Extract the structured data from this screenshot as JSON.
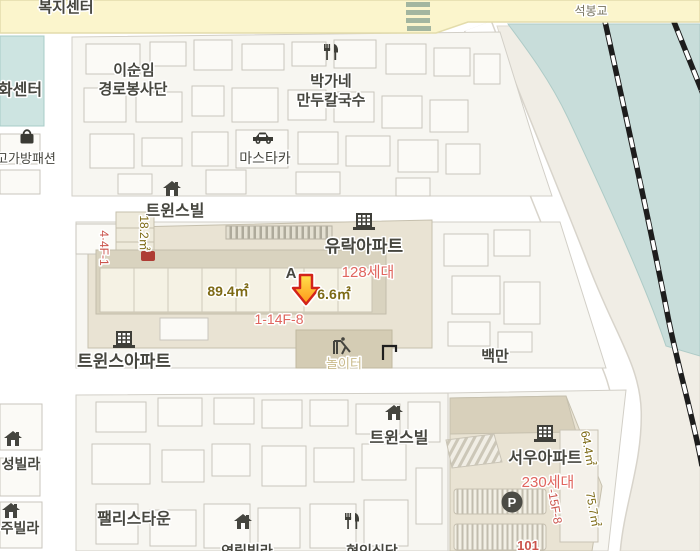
{
  "map": {
    "type": "static-map-viewport",
    "labels": {
      "bokji_center": "복지센터",
      "seokbong_bridge": "석봉교",
      "hwa_center": "화센터",
      "bag_fashion": "고가방패션",
      "isunim_line1": "이순임",
      "isunim_line2": "경로봉사단",
      "parkgane_line1": "박가네",
      "parkgane_line2": "만두칼국수",
      "mastaka": "마스타카",
      "twinsville_top": "트윈스빌",
      "area_18": "18.2㎡",
      "lot_4_4f_1": "4·4F-1",
      "yurak_apartment": "유락아파트",
      "yurak_units": "128세대",
      "marker_block": "A",
      "area_89_4": "89.4㎡",
      "area_6_6": "6.6㎡",
      "lot_1_14f_8": "1-14F-8",
      "twins_apartment": "트윈스아파트",
      "playground": "놀이터",
      "baekman": "백만",
      "twinsville_bottom": "트윈스빌",
      "seou_apartment": "서우아파트",
      "seou_units": "230세대",
      "area_64_4": "64.4㎡",
      "area_75_7": "75.7㎡",
      "lot_15f_8": "-15F-8",
      "building_101": "101",
      "parking_p": "P",
      "sung_villa": "성빌라",
      "ju_villa": "주빌라",
      "palace_town": "팰리스타운",
      "bottom_villa": "연립빌라",
      "bottom_restaurant": "현인식당"
    },
    "icons": {
      "marker": "red-down-arrow",
      "apartment": "building-with-windows-icon",
      "villa": "home-icon",
      "restaurant": "fork-knife-icon",
      "car_dealer": "car-icon",
      "fashion": "bag-icon",
      "playground": "slide-icon",
      "parking": "p-circle-icon",
      "gate": "corner-bracket-icon"
    },
    "colors": {
      "road_yellow": "#fbf5cc",
      "river_teal": "#c8ddda",
      "teal_building": "#cde4e1",
      "block_fill": "#f7f6f1",
      "compound_tan": "#e9e3d3",
      "playground_tan": "#d4ccb4",
      "marker_red": "#d2231a",
      "marker_orange": "#ff9518",
      "units_red": "#e0655e",
      "area_brown": "#7d6a15",
      "railway_black": "#1d1d1d"
    }
  }
}
